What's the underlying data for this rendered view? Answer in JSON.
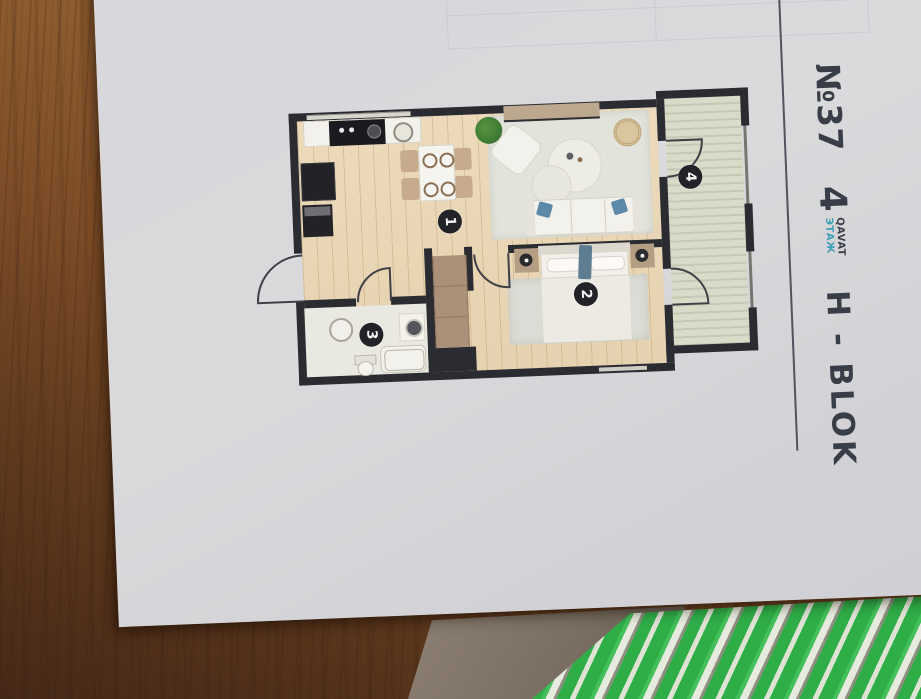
{
  "header": {
    "unit_number": "№37",
    "floor": {
      "number": "4",
      "label_primary": "QAVAT",
      "label_secondary": "ЭТАЖ"
    },
    "block": "H - BLOK"
  },
  "floor_plan": {
    "rooms": [
      {
        "label": "1"
      },
      {
        "label": "2"
      },
      {
        "label": "3"
      },
      {
        "label": "4"
      }
    ]
  },
  "colors": {
    "wall": "#2b2c31",
    "wood_floor": "#e8d6b6",
    "balcony_floor": "#d6d8c6",
    "rug": "#e2e4dc",
    "ink": "#383d47",
    "accent_teal": "#3e9fb5",
    "paper": "#d8d8db",
    "table_wood": "#8a5a32",
    "green_print": "#2fae48"
  }
}
